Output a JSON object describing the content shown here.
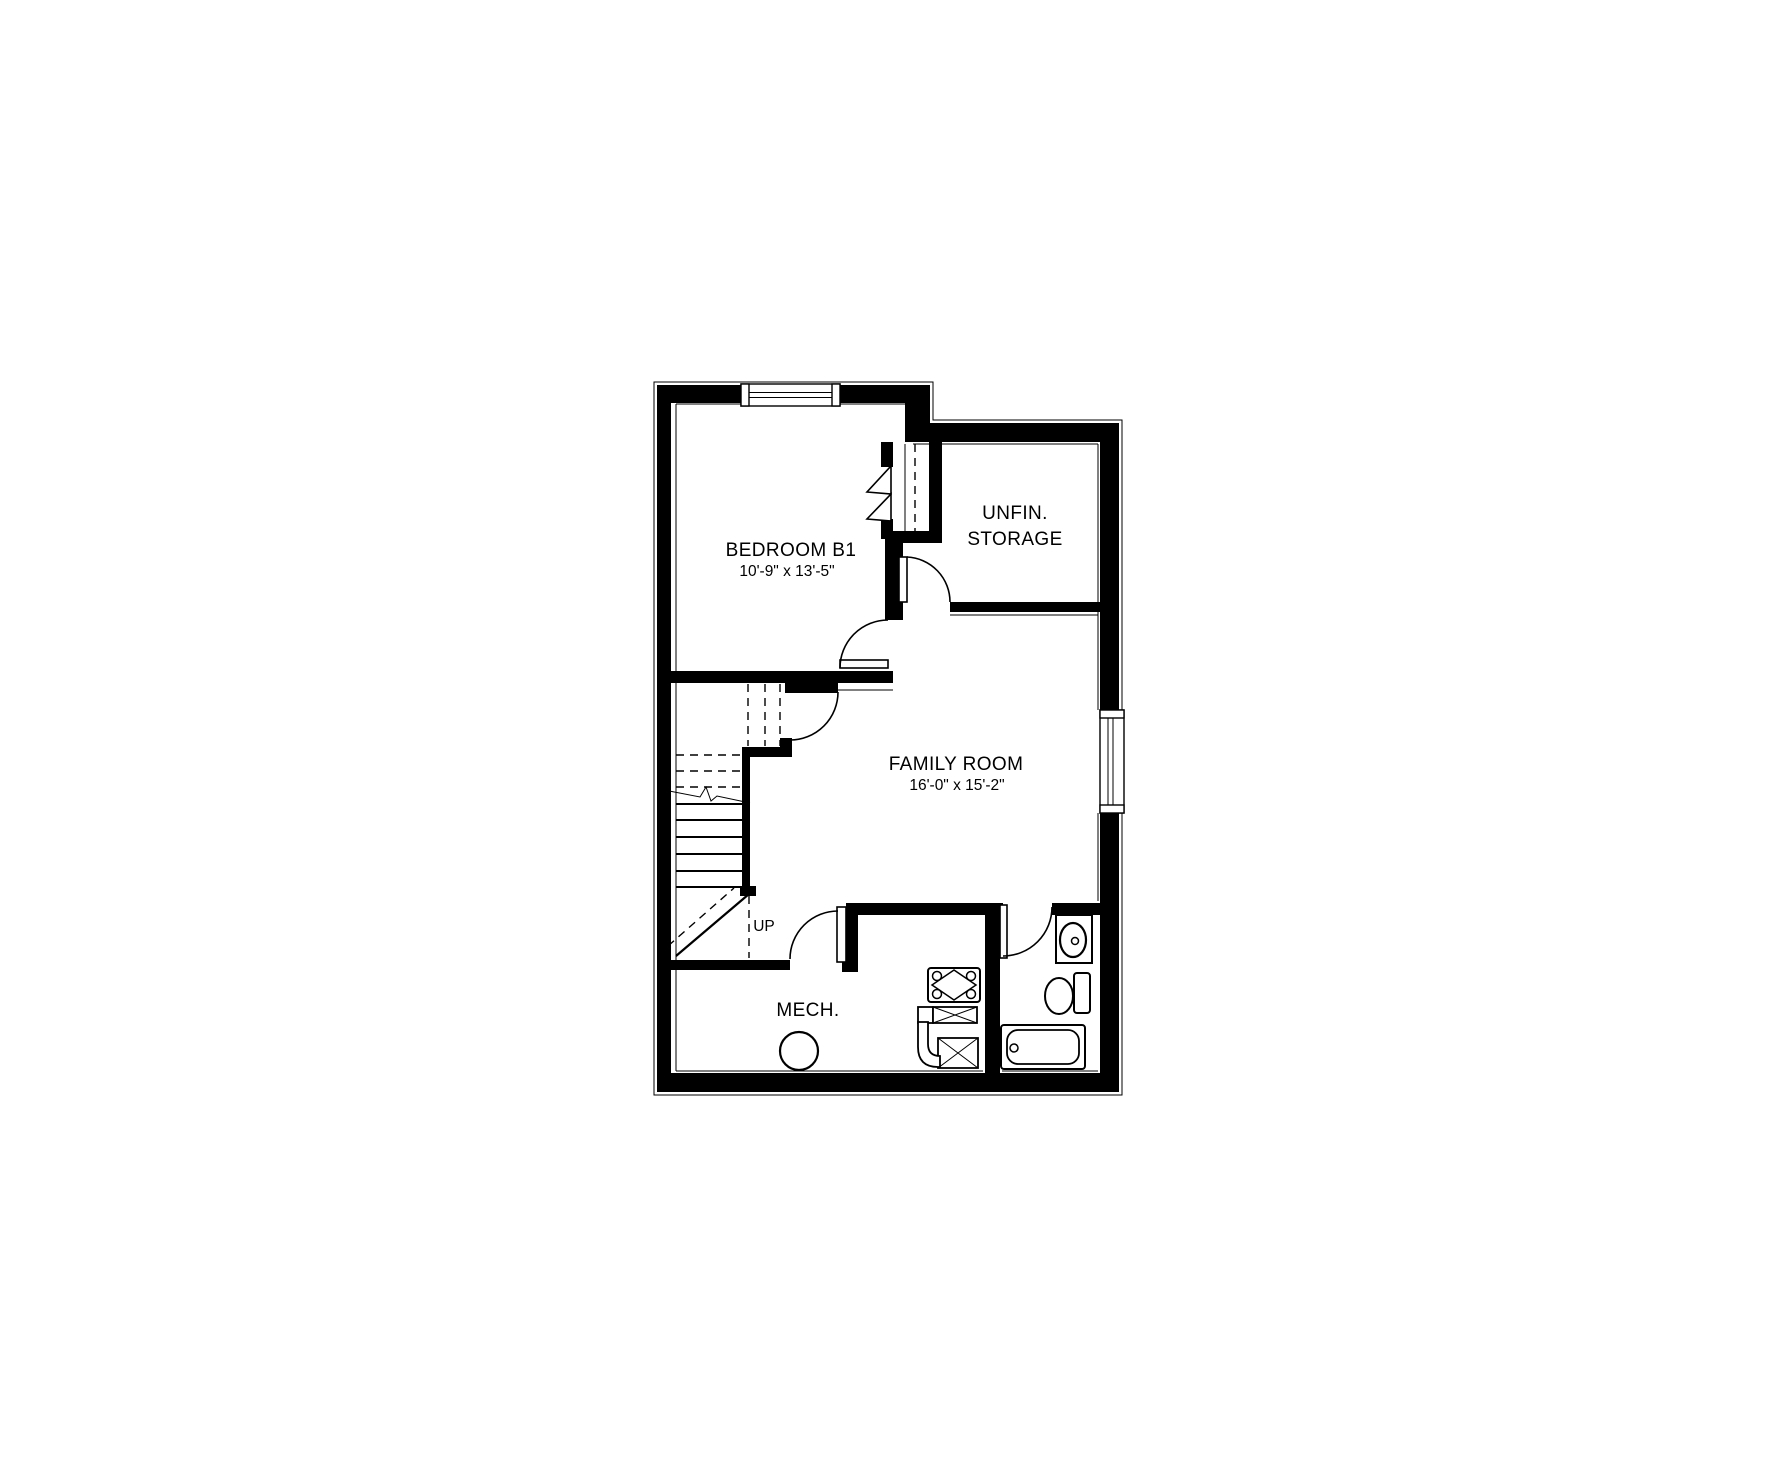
{
  "canvas": {
    "width": 1780,
    "height": 1480,
    "background": "#ffffff",
    "line_color": "#000000"
  },
  "floorplan": {
    "rooms": [
      {
        "id": "bedroom-b1",
        "name": "BEDROOM B1",
        "dimensions": "10'-9\" x 13'-5\""
      },
      {
        "id": "unfinished-storage",
        "name_line1": "UNFIN.",
        "name_line2": "STORAGE"
      },
      {
        "id": "family-room",
        "name": "FAMILY ROOM",
        "dimensions": "16'-0\" x 15'-2\""
      },
      {
        "id": "mechanical",
        "name": "MECH."
      }
    ],
    "stairs": {
      "label": "UP",
      "treads_solid": 6,
      "treads_dashed": 3
    },
    "windows": [
      {
        "id": "bedroom-window",
        "wall": "top"
      },
      {
        "id": "family-room-window",
        "wall": "right"
      }
    ],
    "doors": [
      {
        "id": "bedroom-door",
        "type": "swing"
      },
      {
        "id": "bedroom-closet-door",
        "type": "bifold"
      },
      {
        "id": "storage-door",
        "type": "swing"
      },
      {
        "id": "stair-hall-door",
        "type": "swing"
      },
      {
        "id": "mech-door",
        "type": "swing"
      },
      {
        "id": "bathroom-door",
        "type": "swing"
      }
    ],
    "fixtures": [
      {
        "id": "vanity-sink"
      },
      {
        "id": "toilet"
      },
      {
        "id": "bathtub"
      },
      {
        "id": "furnace"
      },
      {
        "id": "water-heater"
      },
      {
        "id": "duct-elbow"
      },
      {
        "id": "floor-drain"
      }
    ]
  }
}
